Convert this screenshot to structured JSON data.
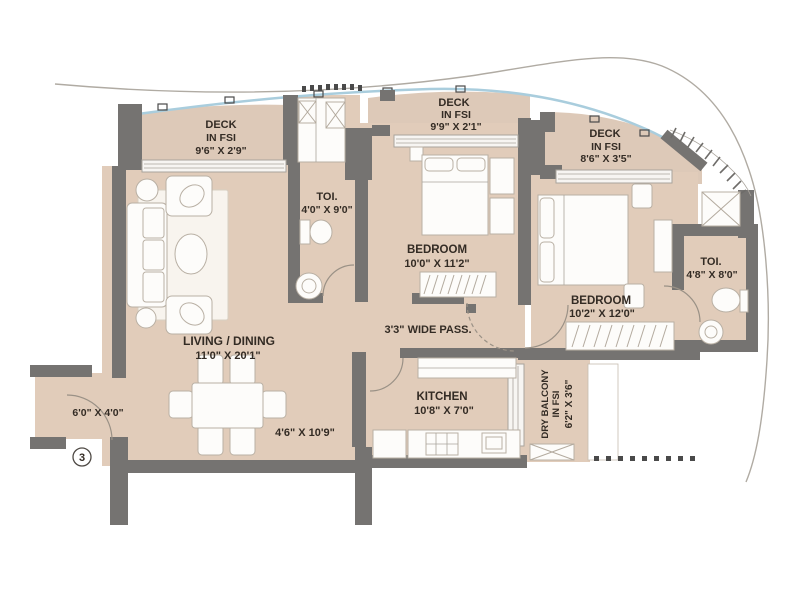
{
  "meta": {
    "unit_label": "3",
    "drawing_type": "apartment-floor-plan"
  },
  "colors": {
    "wall": "#757371",
    "floor": "#e1ccba",
    "deck_floor": "#ddc9b8",
    "glass_rail": "#a9cddd",
    "text": "#332b24",
    "background": "#ffffff"
  },
  "rooms": {
    "deck_left": {
      "line1": "DECK",
      "line2": "IN FSI",
      "dims": "9'6\" X 2'9\""
    },
    "deck_mid": {
      "line1": "DECK",
      "line2": "IN FSI",
      "dims": "9'9\" X 2'1\""
    },
    "deck_right": {
      "line1": "DECK",
      "line2": "IN FSI",
      "dims": "8'6\" X 3'5\""
    },
    "toilet_left": {
      "name": "TOI.",
      "dims": "4'0\" X 9'0\""
    },
    "toilet_right": {
      "name": "TOI.",
      "dims": "4'8\" X 8'0\""
    },
    "bedroom_left": {
      "name": "BEDROOM",
      "dims": "10'0\" X 11'2\""
    },
    "bedroom_right": {
      "name": "BEDROOM",
      "dims": "10'2\" X 12'0\""
    },
    "living_dining": {
      "name": "LIVING / DINING",
      "dims": "11'0\" X 20'1\""
    },
    "passage": {
      "name": "3'3\" WIDE PASS."
    },
    "passage2": {
      "dims": "4'6\" X 10'9\""
    },
    "kitchen": {
      "name": "KITCHEN",
      "dims": "10'8\" X 7'0\""
    },
    "dry_balcony": {
      "line1": "DRY BALCONY",
      "line2": "IN FSI",
      "dims": "6'2\" X 3'6\""
    },
    "foyer": {
      "dims": "6'0\" X 4'0\""
    }
  }
}
